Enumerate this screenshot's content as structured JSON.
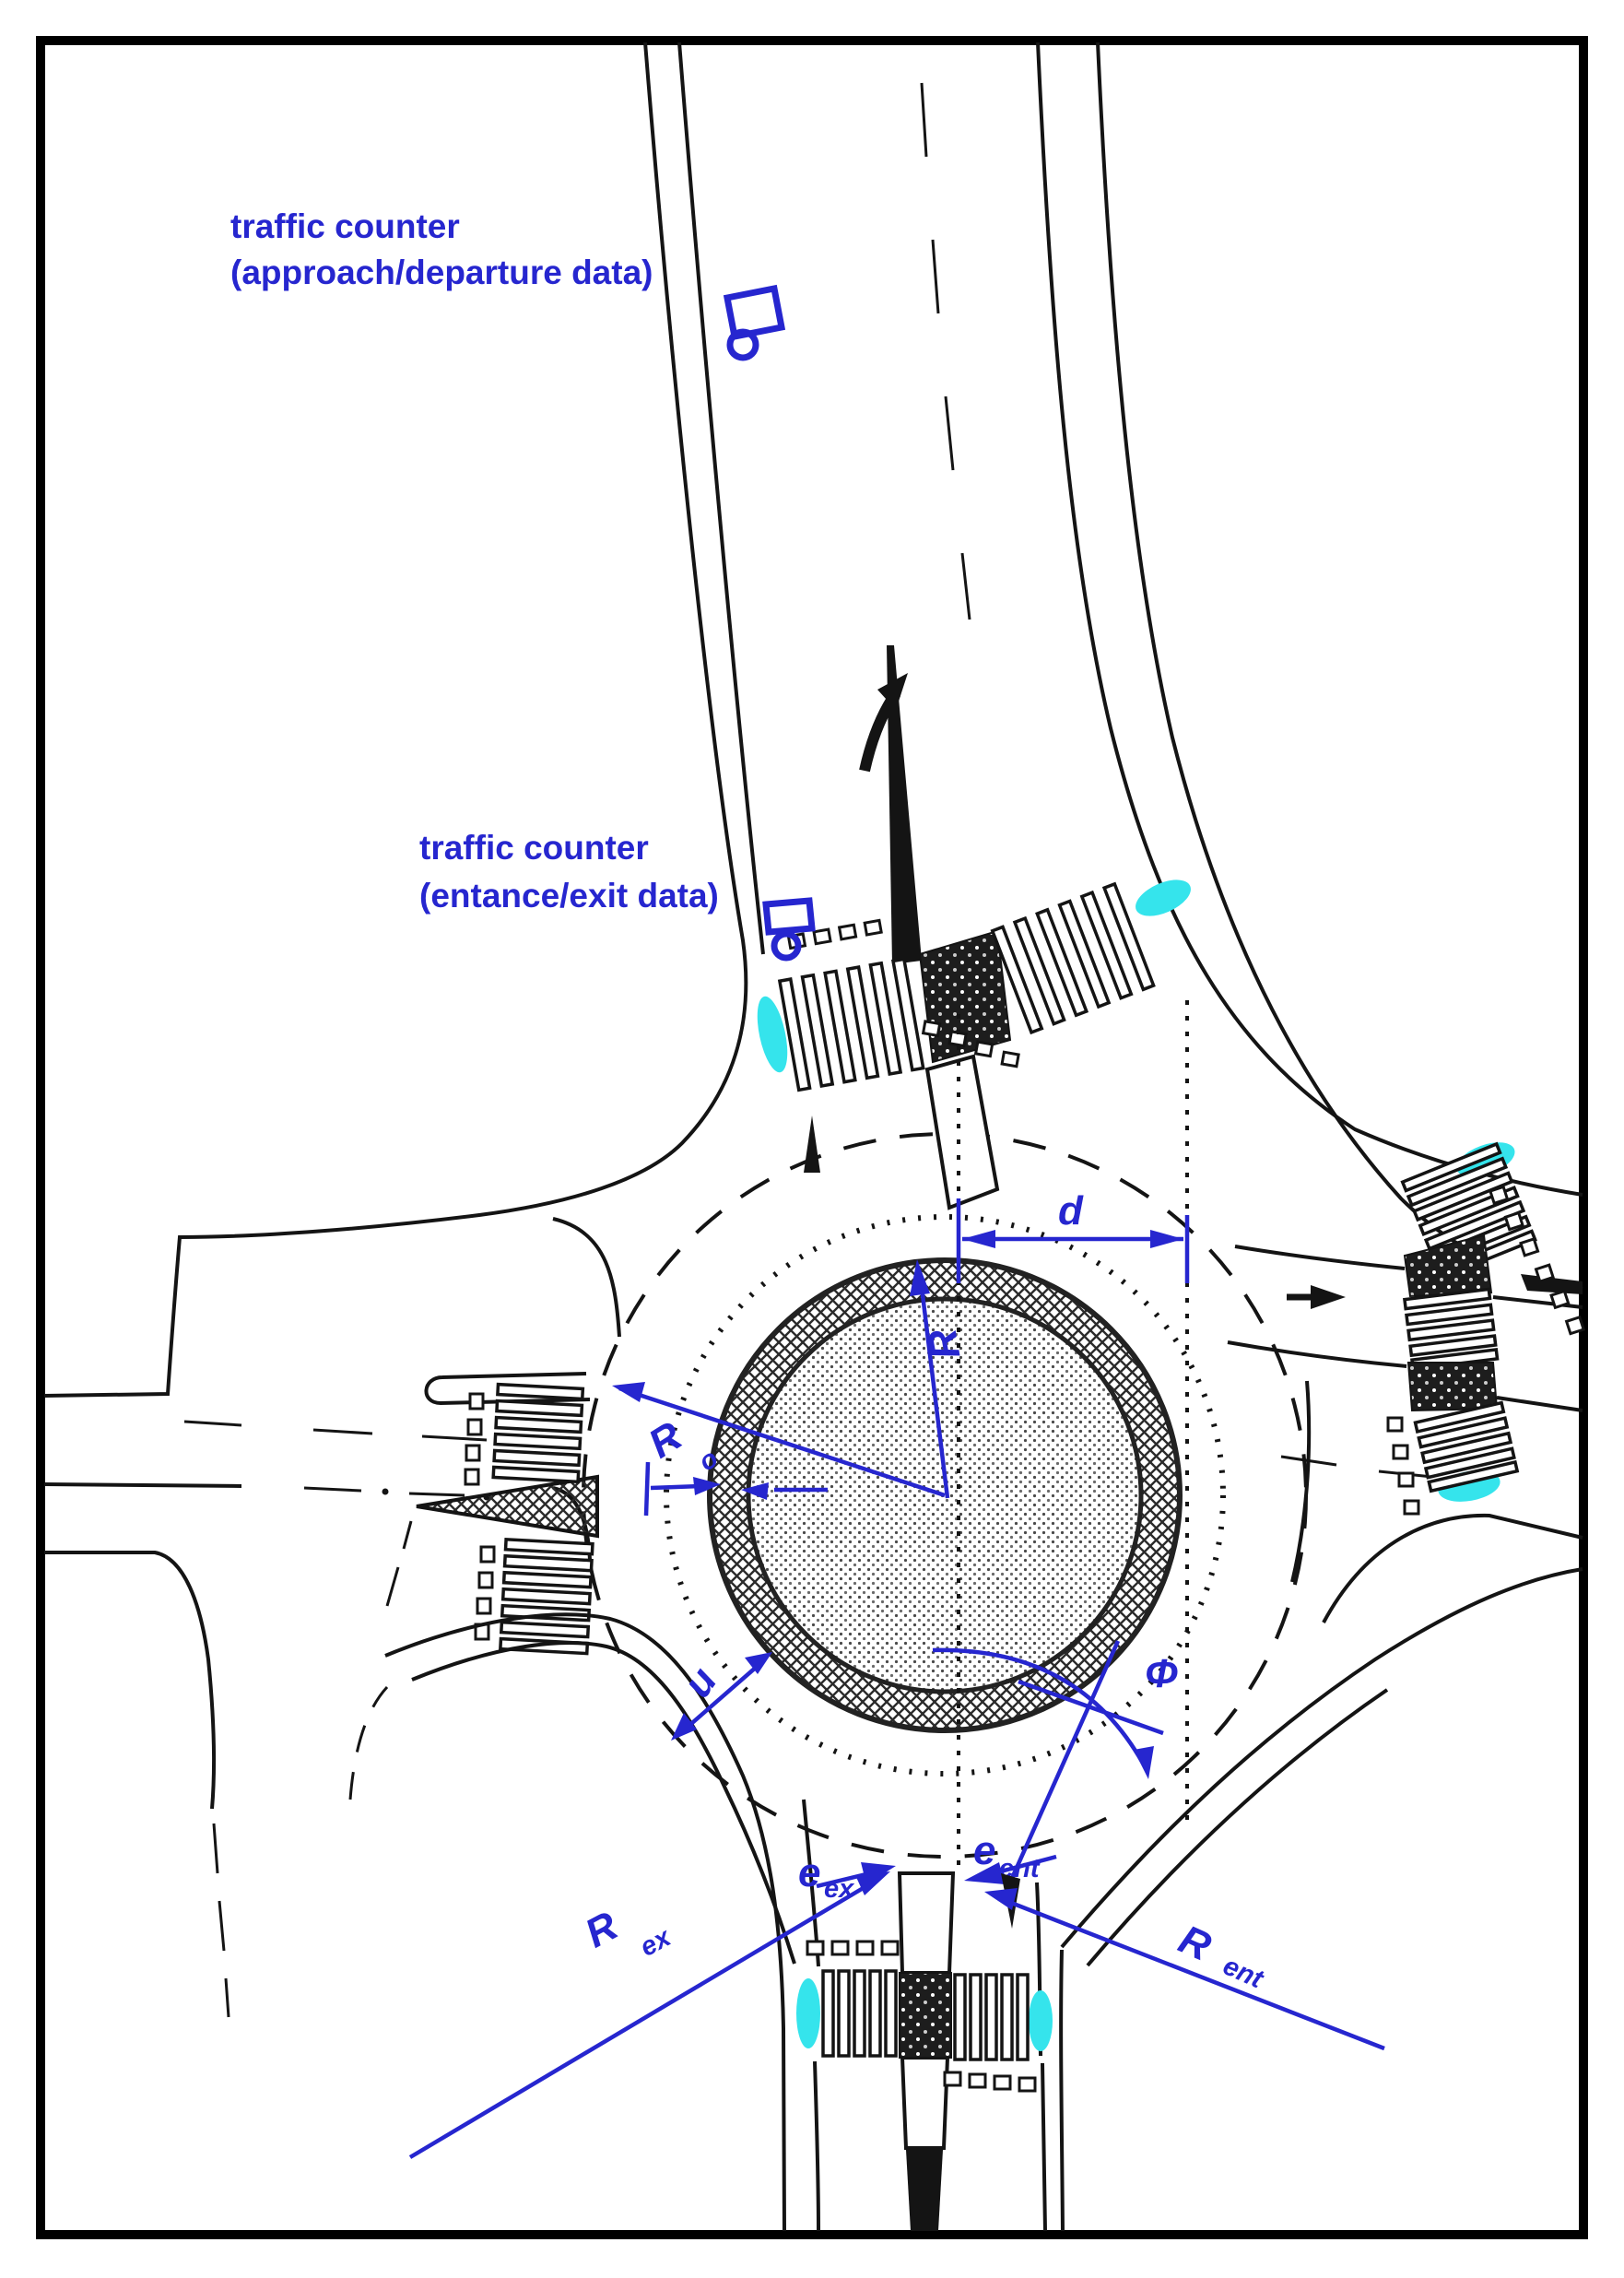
{
  "figure": {
    "type": "roundabout-geometry-diagram",
    "annotations": {
      "counter1_line1": "traffic counter",
      "counter1_line2": "(approach/departure data)",
      "counter2_line1": "traffic counter",
      "counter2_line2": "(entance/exit data)"
    },
    "dimensions": {
      "d": "d",
      "R": "R",
      "Ro_base": "R",
      "Ro_sub": "o",
      "u": "u",
      "phi": "Φ",
      "eex_base": "e",
      "eex_sub": "ex",
      "eent_base": "e",
      "eent_sub": "ent",
      "Rex_base": "R",
      "Rex_sub": "ex",
      "Rent_base": "R",
      "Rent_sub": "ent"
    },
    "icons": [
      "traffic-counter-icon",
      "traffic-counter-icon"
    ],
    "colors": {
      "blue": "#2626cf",
      "cyan": "#35e4ec",
      "ink": "#141414"
    }
  }
}
